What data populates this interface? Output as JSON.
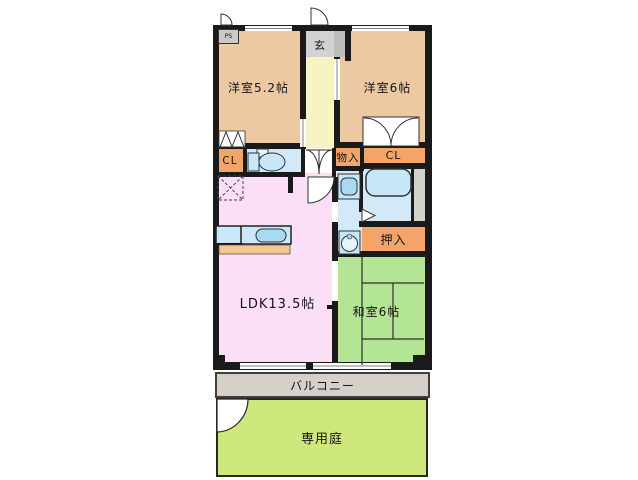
{
  "labels": {
    "yoshitsu52": "洋室5.2帖",
    "yoshitsu6": "洋室6帖",
    "genkan": "玄",
    "cl_left": "CL",
    "cl_right": "CL",
    "monoiri": "物入",
    "oshiire": "押入",
    "ldk": "LDK13.5帖",
    "washitsu": "和室6帖",
    "balcony": "バルコニー",
    "garden": "専用庭",
    "ps": "PS"
  },
  "colors": {
    "wall": "#1a1a1a",
    "tan": "#ecc9a2",
    "cream": "#f8f3c3",
    "genkan": "#d2d2d2",
    "genkan_side": "#bdbdbd",
    "orange": "#f2a469",
    "counter_front": "#f6c78e",
    "blue": "#d3e9f8",
    "fixture": "#c7e7f9",
    "fixture_deep": "#a9daf2",
    "pink": "#fbdff6",
    "green": "#b4e595",
    "balcony": "#d6d0c8",
    "garden": "#cfe87d",
    "ps_box": "#c9c9c9",
    "ps_strip": "#d2d2c9"
  }
}
